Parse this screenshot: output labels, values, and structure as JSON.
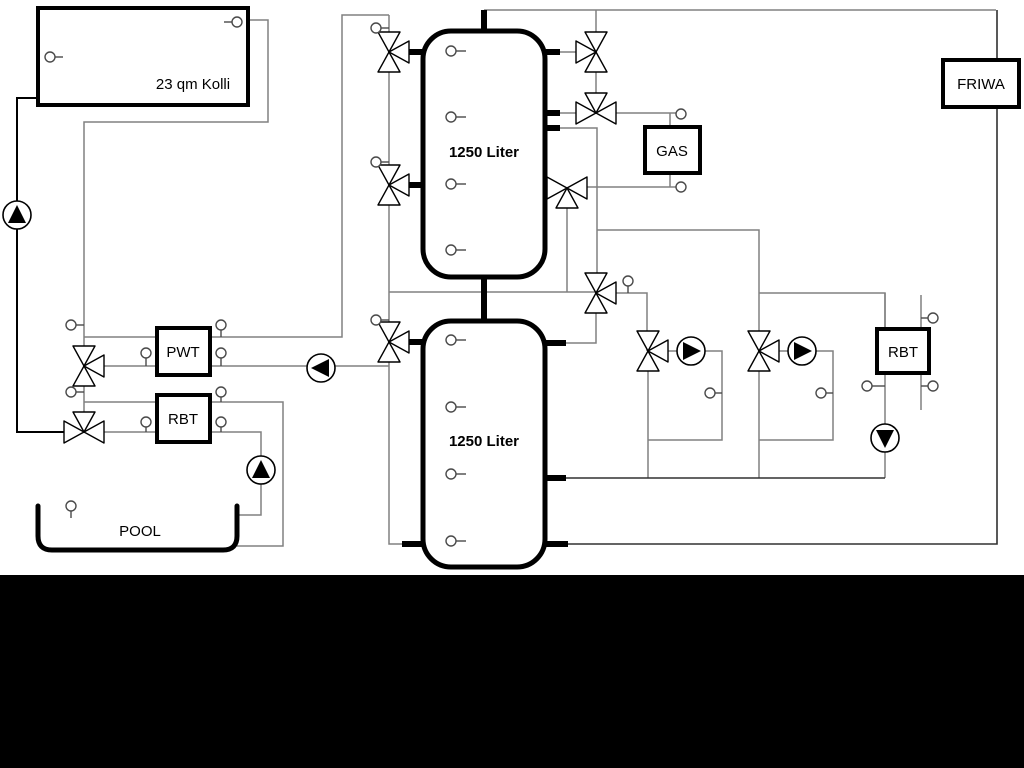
{
  "diagram": {
    "type": "hydraulic-heating-schematic",
    "background_color": "#ffffff",
    "bottom_bar_color": "#000000",
    "pipe_colors": {
      "gray": "#808080",
      "black": "#000000"
    },
    "labels": {
      "collector": "23 qm Kolli",
      "tank_upper": "1250 Liter",
      "tank_lower": "1250 Liter",
      "pwt": "PWT",
      "rbt_left": "RBT",
      "rbt_right": "RBT",
      "gas": "GAS",
      "friwa": "FRIWA",
      "pool": "POOL"
    },
    "components": {
      "three_way_valves": 11,
      "pumps": 6,
      "temperature_sensors": 30,
      "pump_list": [
        {
          "name": "solar-pump",
          "arrow": "up"
        },
        {
          "name": "pwt-circuit-pump",
          "arrow": "left"
        },
        {
          "name": "pool-feed-pump",
          "arrow": "up"
        },
        {
          "name": "heating-circuit-1-pump",
          "arrow": "right"
        },
        {
          "name": "heating-circuit-2-pump",
          "arrow": "right"
        },
        {
          "name": "rbt-return-pump",
          "arrow": "down"
        }
      ],
      "vessels": [
        {
          "name": "solar-collector",
          "label_key": "collector"
        },
        {
          "name": "buffer-tank-upper",
          "label_key": "tank_upper"
        },
        {
          "name": "buffer-tank-lower",
          "label_key": "tank_lower"
        },
        {
          "name": "plate-heat-exchanger",
          "label_key": "pwt"
        },
        {
          "name": "rbt-left-unit",
          "label_key": "rbt_left"
        },
        {
          "name": "gas-boiler",
          "label_key": "gas"
        },
        {
          "name": "rbt-right-unit",
          "label_key": "rbt_right"
        },
        {
          "name": "fresh-water-station",
          "label_key": "friwa"
        },
        {
          "name": "swimming-pool",
          "label_key": "pool"
        }
      ]
    }
  }
}
